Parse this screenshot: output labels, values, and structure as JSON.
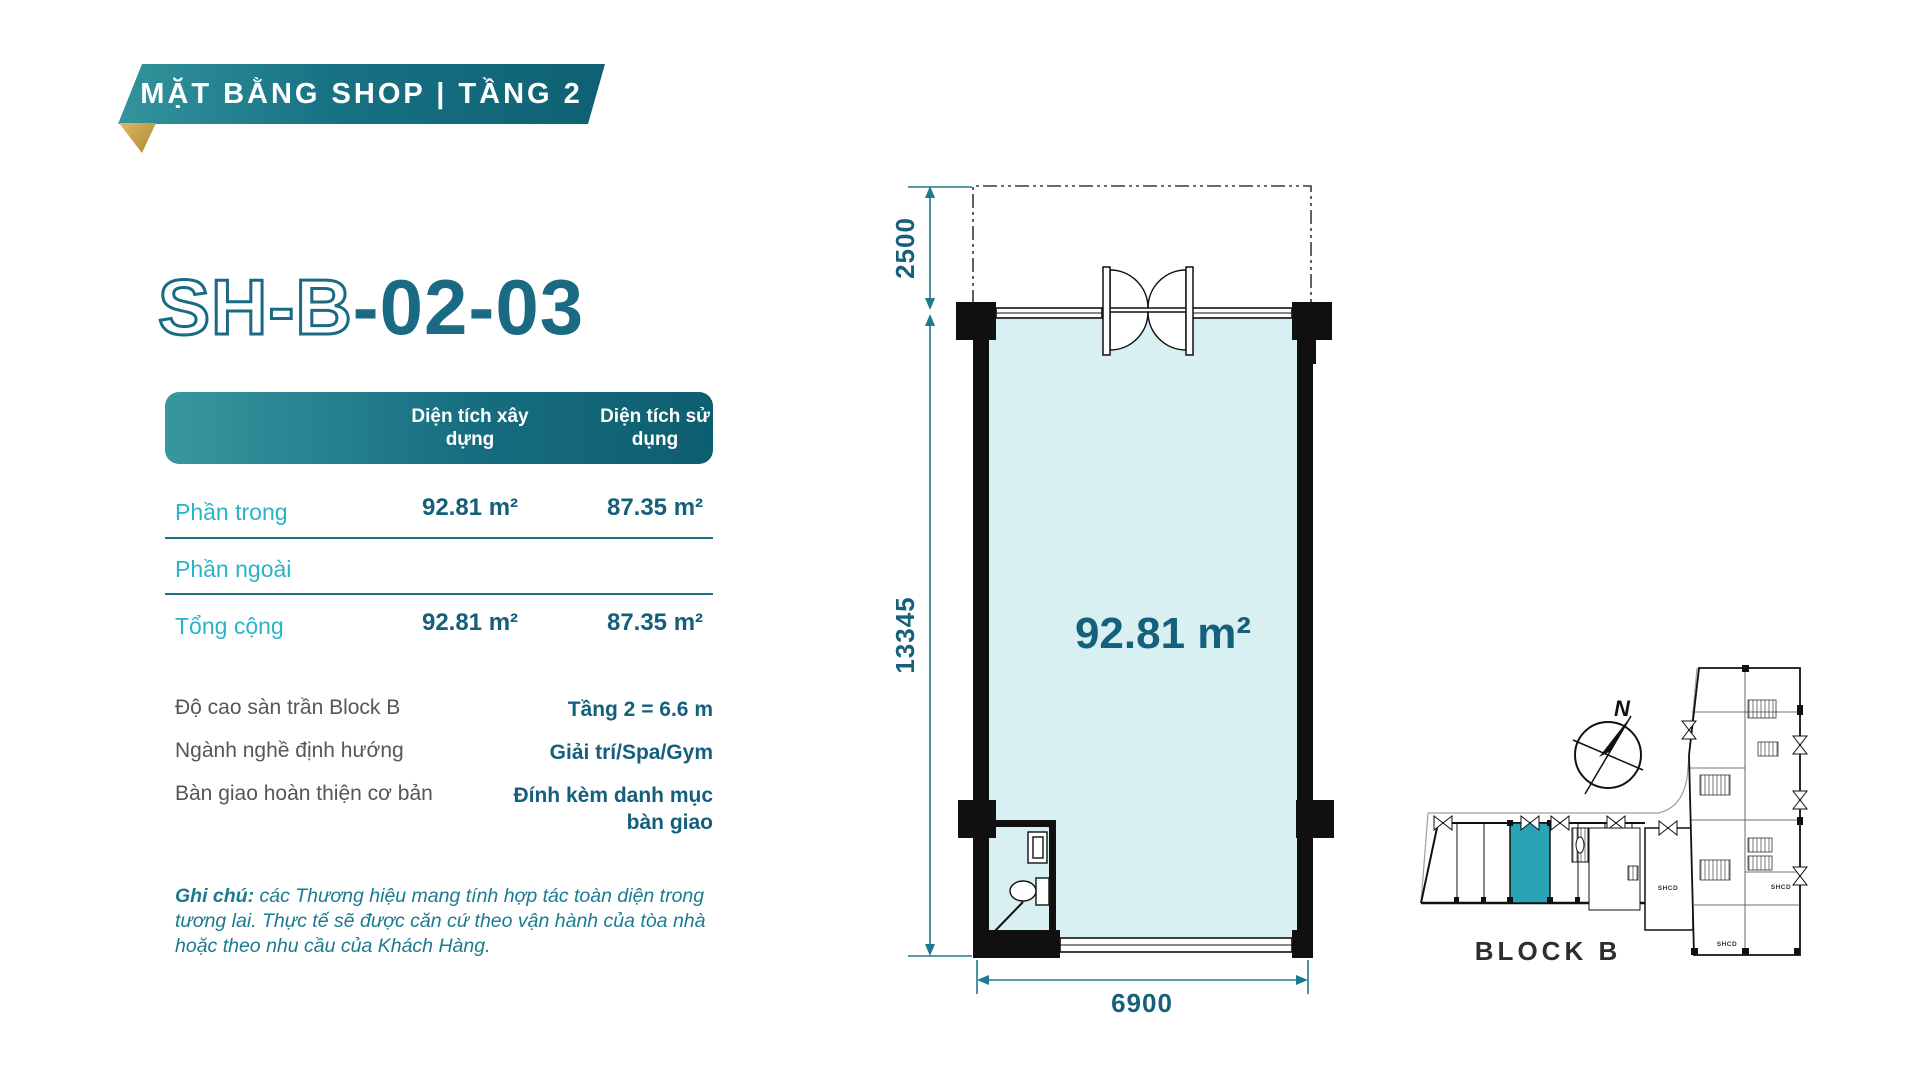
{
  "banner": {
    "title": "MẶT BẰNG SHOP | TẦNG 2"
  },
  "unit": {
    "code_outline": "SH-B",
    "code_solid": "-02-03"
  },
  "table": {
    "headers": [
      "Diện tích xây dựng",
      "Diện tích sử dụng"
    ],
    "rows": [
      {
        "label": "Phần trong",
        "built": "92.81 m²",
        "usable": "87.35 m²"
      },
      {
        "label": "Phần ngoài"
      },
      {
        "label": "Tổng cộng",
        "built": "92.81 m²",
        "usable": "87.35 m²"
      }
    ]
  },
  "details": [
    {
      "label": "Độ cao sàn trần Block B",
      "value": "Tầng 2 = 6.6 m"
    },
    {
      "label": "Ngành nghề định hướng",
      "value": "Giải trí/Spa/Gym"
    },
    {
      "label": "Bàn giao hoàn thiện cơ bản",
      "value": "Đính kèm danh mục bàn giao"
    }
  ],
  "note": {
    "label": "Ghi chú:",
    "text": " các Thương hiệu mang tính hợp tác toàn diện trong tương lai. Thực tế sẽ được căn cứ theo vận hành của tòa nhà hoặc theo nhu cầu của Khách Hàng."
  },
  "floorplan": {
    "area": "92.81 m²",
    "dim_top": "2500",
    "dim_side": "13345",
    "dim_bottom": "6900"
  },
  "keyplan": {
    "block": "BLOCK B",
    "north": "N",
    "shcd": [
      "SHCD",
      "SHCD",
      "SHCD"
    ]
  },
  "colors": {
    "accent_teal": "#14607c",
    "cyan_label": "#29b4c6",
    "header_gradient_start": "#37979f",
    "header_gradient_end": "#0d5e70",
    "room_fill": "#d9f0f2",
    "highlight_unit": "#28a4b5",
    "gold_fold": "#ddb965"
  }
}
